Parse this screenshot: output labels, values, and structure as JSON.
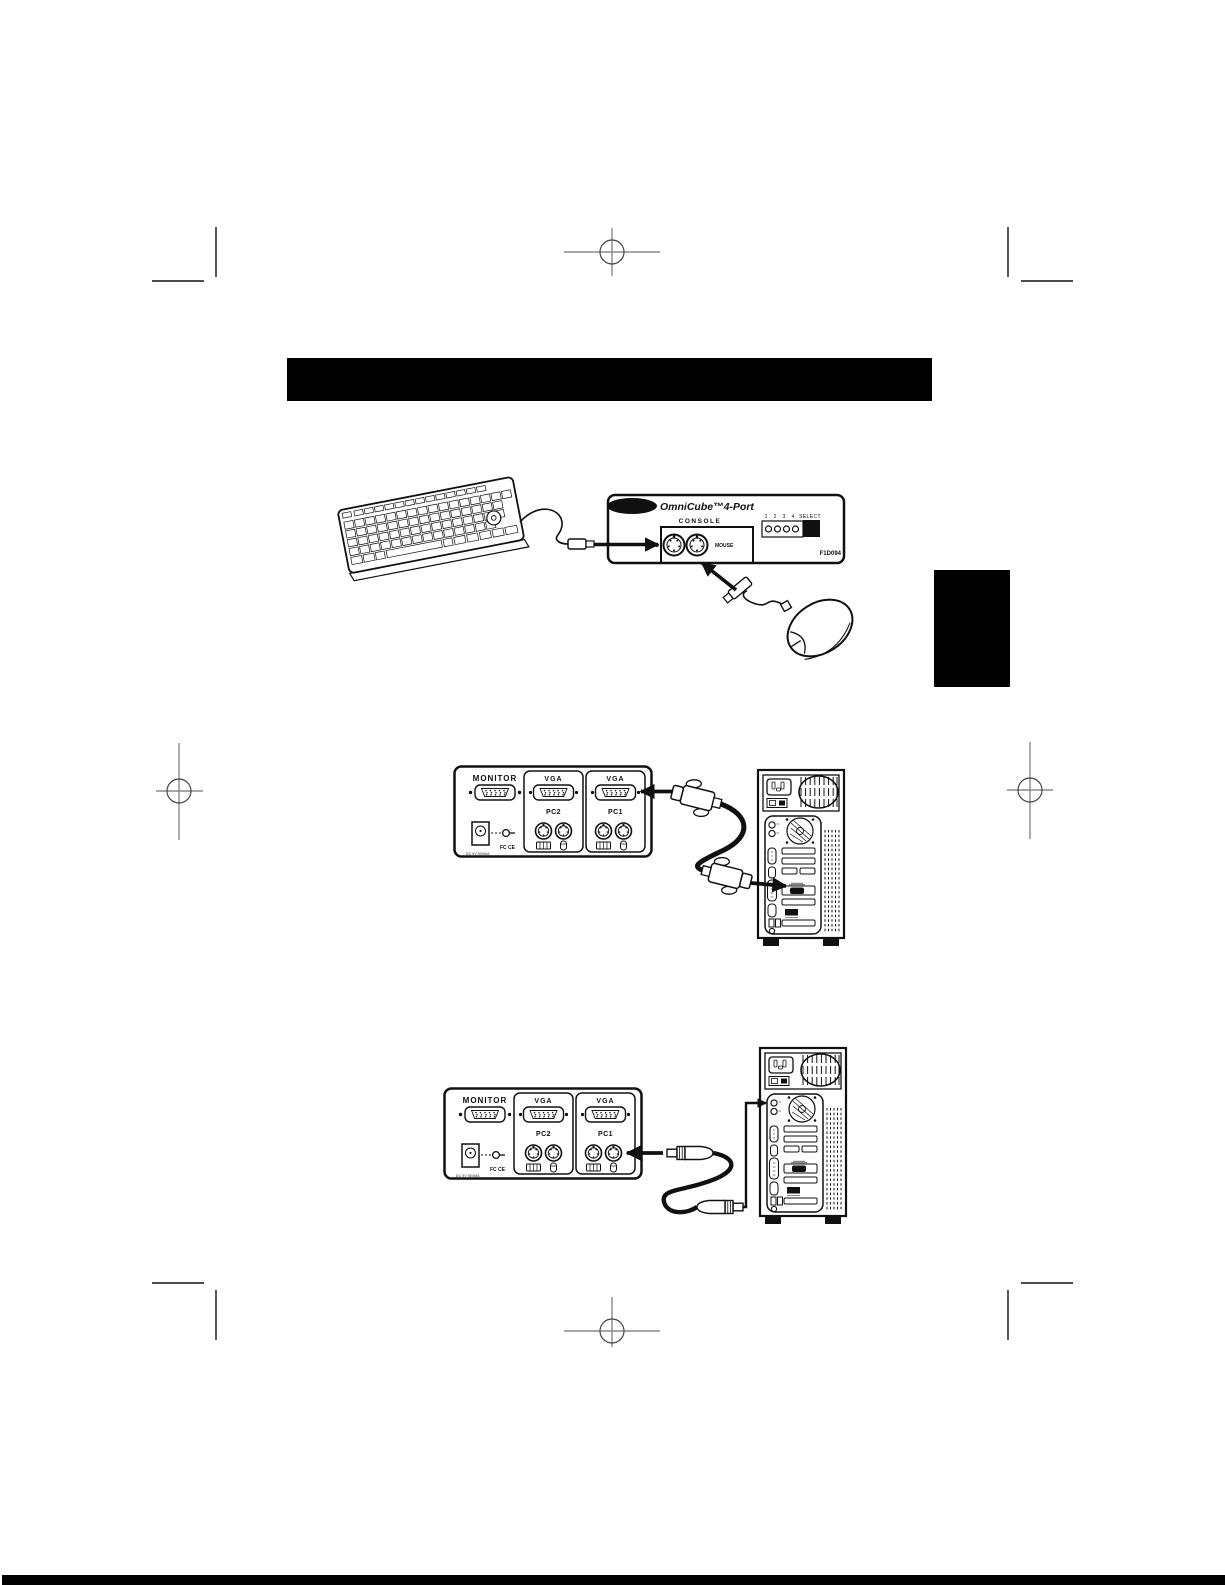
{
  "front_panel": {
    "brand": "BELKIN",
    "product": "OmniCube™4-Port",
    "console_label": "CONSOLE",
    "kybd_label": "KYBD",
    "mouse_label": "MOUSE",
    "led_labels": [
      "1",
      "2",
      "3",
      "4"
    ],
    "select_label": "SELECT",
    "model": "F1D094"
  },
  "back_panel": {
    "monitor_label": "MONITOR",
    "vga_label": "VGA",
    "pc2_label": "PC2",
    "pc1_label": "PC1",
    "approval_marks": "FC CE",
    "power_rating": "DC 9V 500MA"
  },
  "colors": {
    "ink": "#101010",
    "paper": "#ffffff",
    "header_bar": "#000000"
  }
}
